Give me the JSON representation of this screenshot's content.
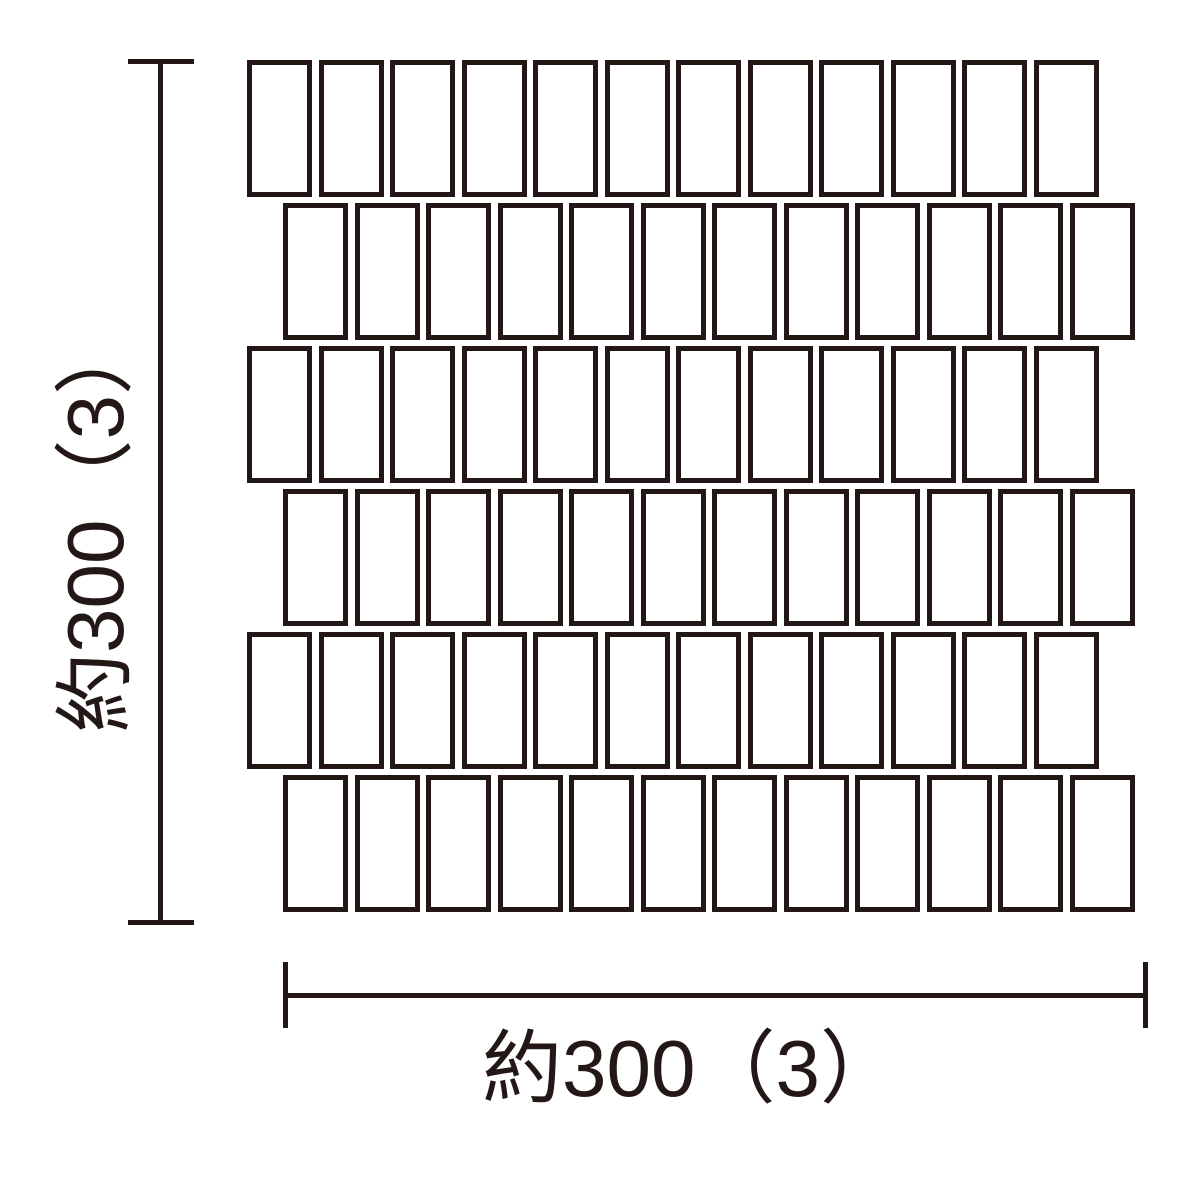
{
  "diagram": {
    "type": "tile-mosaic-sheet-dimension-drawing",
    "background_color": "#ffffff",
    "ink_color": "#231815",
    "labels": {
      "height_dimension": "約300（3）",
      "width_dimension": "約300（3）"
    },
    "grid": {
      "rows": 6,
      "tiles_per_row": 12,
      "origin_x": 247,
      "origin_y": 60,
      "tile_width": 65,
      "tile_height": 137,
      "horizontal_pitch": 71.5,
      "vertical_pitch": 143,
      "even_row_offset_x": 36,
      "stroke_width": 5,
      "stroke_color": "#231815",
      "fill_color": "#ffffff"
    }
  }
}
